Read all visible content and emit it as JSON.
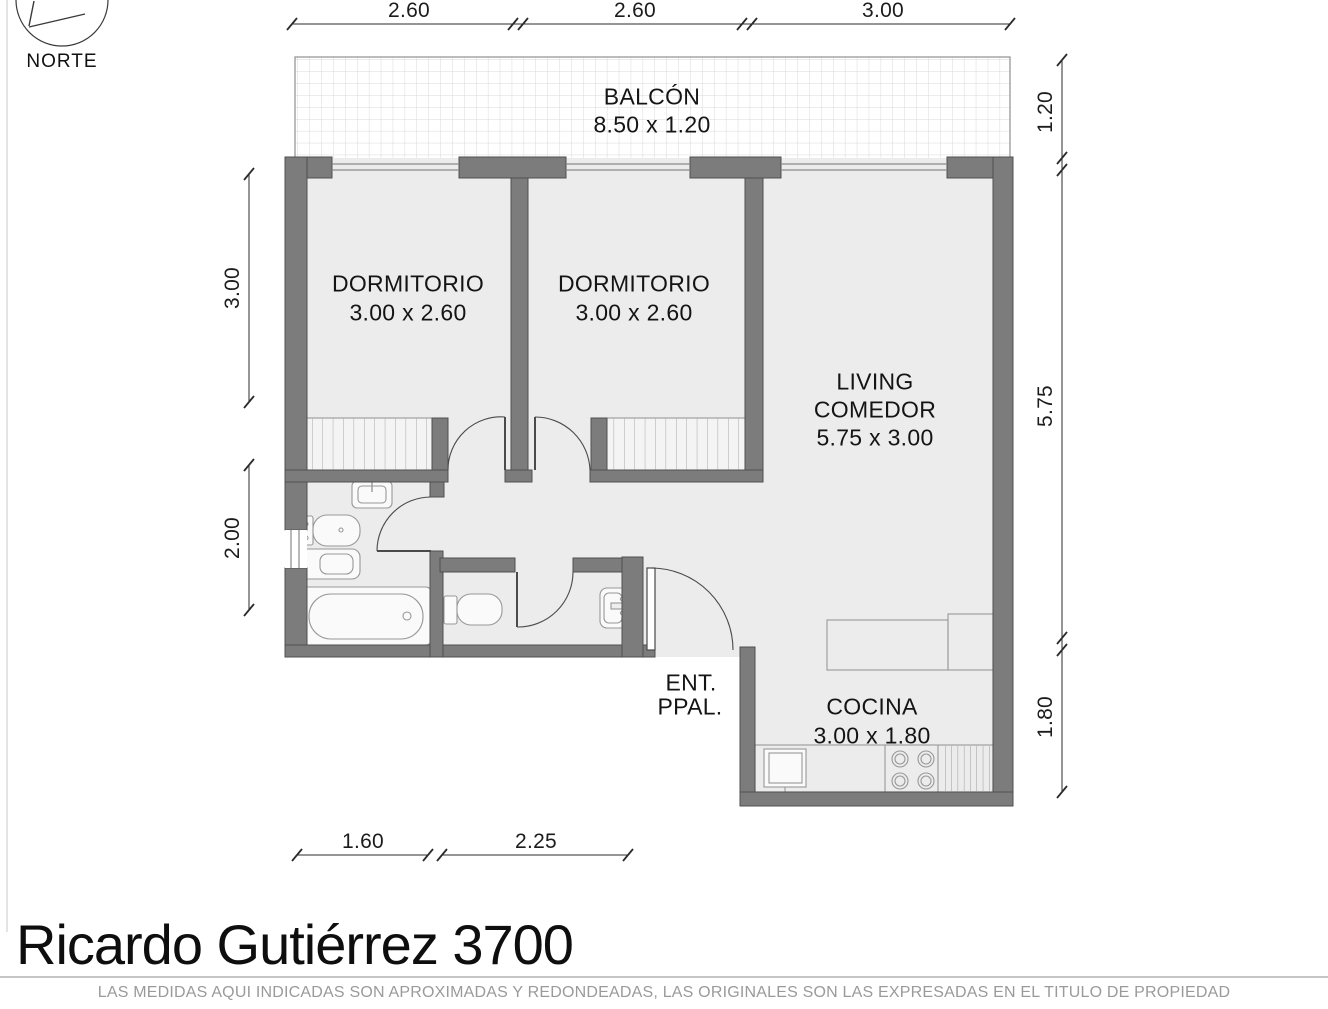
{
  "compass": {
    "label": "NORTE"
  },
  "rooms": {
    "balcony": {
      "name": "BALCÓN",
      "size": "8.50 x 1.20"
    },
    "bedroom1": {
      "name": "DORMITORIO",
      "size": "3.00 x 2.60"
    },
    "bedroom2": {
      "name": "DORMITORIO",
      "size": "3.00 x 2.60"
    },
    "living": {
      "line1": "LIVING",
      "line2": "COMEDOR",
      "size": "5.75 x 3.00"
    },
    "kitchen": {
      "name": "COCINA",
      "size": "3.00 x 1.80"
    },
    "entry": {
      "line1": "ENT.",
      "line2": "PPAL."
    }
  },
  "dimensions": {
    "top1": "2.60",
    "top2": "2.60",
    "top3": "3.00",
    "left1": "3.00",
    "left2": "2.00",
    "right1": "1.20",
    "right2": "5.75",
    "right3": "1.80",
    "bottom1": "1.60",
    "bottom2": "2.25"
  },
  "title": {
    "text": "Ricardo Gutiérrez 3700"
  },
  "footer": {
    "text": "LAS MEDIDAS AQUI INDICADAS SON APROXIMADAS Y REDONDEADAS, LAS ORIGINALES SON LAS EXPRESADAS EN EL TITULO DE PROPIEDAD"
  }
}
